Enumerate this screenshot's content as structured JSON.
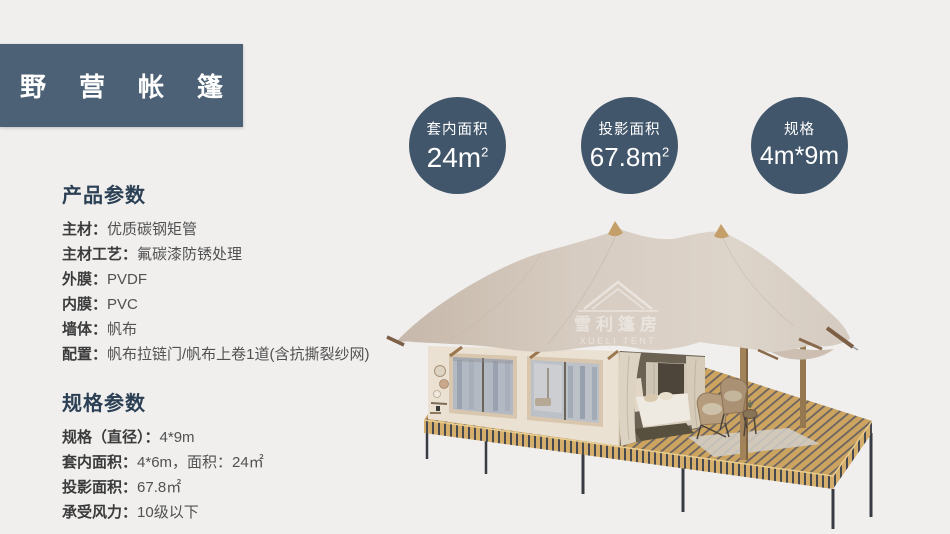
{
  "colors": {
    "background": "#f0efee",
    "header_box": "#4c6175",
    "badge_circle": "#42566b",
    "heading_text": "#2b4054",
    "canopy_beige": "#d7ccc1",
    "deck_wood": "#cda55f"
  },
  "header": {
    "title": "野营帐篷"
  },
  "badges": [
    {
      "label": "套内面积",
      "value": "24m",
      "sup": "2"
    },
    {
      "label": "投影面积",
      "value": "67.8m",
      "sup": "2"
    },
    {
      "label": "规格",
      "value": "4m*9m",
      "sup": ""
    }
  ],
  "product_params": {
    "heading": "产品参数",
    "rows": [
      {
        "label": "主材：",
        "value": "优质碳钢矩管"
      },
      {
        "label": "主材工艺：",
        "value": "氟碳漆防锈处理"
      },
      {
        "label": "外膜：",
        "value": "PVDF"
      },
      {
        "label": "内膜：",
        "value": "PVC"
      },
      {
        "label": "墙体：",
        "value": "帆布"
      },
      {
        "label": "配置：",
        "value": "帆布拉链门/帆布上卷1道(含抗撕裂纱网)"
      }
    ]
  },
  "spec_params": {
    "heading": "规格参数",
    "rows": [
      {
        "label": "规格（直径）：",
        "value": "4*9m"
      },
      {
        "label": "套内面积：",
        "value": "4*6m，面积：24㎡"
      },
      {
        "label": "投影面积：",
        "value": "67.8㎡"
      },
      {
        "label": "承受风力：",
        "value": "10级以下"
      }
    ]
  },
  "watermark": {
    "cn": "雪利篷房",
    "en": "XUELI TENT"
  }
}
